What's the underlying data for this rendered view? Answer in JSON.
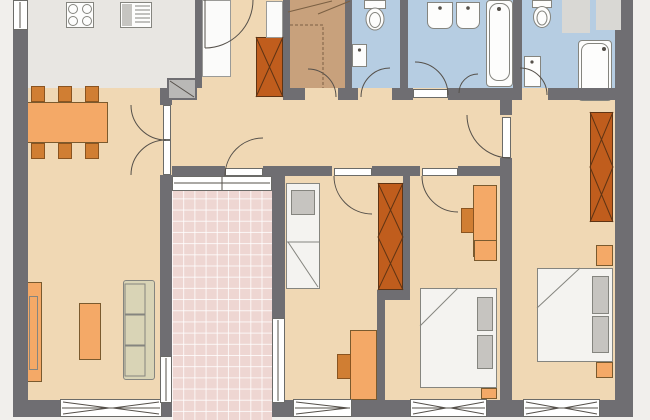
{
  "palette": {
    "wall": "#6f6e72",
    "stroke": "#55504a",
    "floor": "#f0d8b4",
    "kitchen_floor": "#e8e6e2",
    "bath_floor": "#b6cde2",
    "storage_floor": "#c8a17c",
    "terrace_floor": "#eed6d2",
    "margin": "#f1efec",
    "orange_light": "#f4a967",
    "orange_mid": "#d07e33",
    "orange_dark": "#c05d1d",
    "fixture_white": "#fdfdfc",
    "fixture_outline": "#85857f",
    "gray_item": "#c6c4c0",
    "niche_gray": "#d9d8d4",
    "sofa": "#d9d4b6"
  },
  "floor_plan": {
    "type": "apartment-floor-plan",
    "rooms": [
      {
        "name": "kitchen",
        "floor": "kitchen_floor",
        "fixtures": [
          "stove-4-burner",
          "kitchen-appliance",
          "tall-white-cabinet"
        ]
      },
      {
        "name": "living-dining-room",
        "floor": "floor",
        "fixtures": [
          "dining-table",
          "dining-chair x6",
          "tv-lowboard",
          "coffee-table",
          "sofa-3-seat",
          "double-door"
        ]
      },
      {
        "name": "entry-hall",
        "floor": "floor",
        "fixtures": [
          "entry-door",
          "wardrobe",
          "mirror-cabinet",
          "duct-shaft"
        ]
      },
      {
        "name": "storage-room",
        "floor": "storage_floor",
        "fixtures": [
          "dashed-shelving",
          "door"
        ]
      },
      {
        "name": "wc",
        "floor": "bath_floor",
        "fixtures": [
          "toilet",
          "hand-basin",
          "door"
        ]
      },
      {
        "name": "bathroom-1",
        "floor": "bath_floor",
        "fixtures": [
          "washbasin x2",
          "bathtub",
          "door"
        ]
      },
      {
        "name": "bathroom-2",
        "floor": "bath_floor",
        "fixtures": [
          "toilet",
          "hand-basin",
          "bathtub",
          "wall-niche x2",
          "door"
        ]
      },
      {
        "name": "bedroom-1",
        "floor": "floor",
        "fixtures": [
          "single-bed",
          "pillow",
          "wardrobe",
          "desk",
          "chair",
          "window",
          "door"
        ]
      },
      {
        "name": "bedroom-2",
        "floor": "floor",
        "fixtures": [
          "double-bed",
          "pillow x2",
          "desk",
          "chair",
          "nightstand x2",
          "window",
          "door"
        ]
      },
      {
        "name": "bedroom-3",
        "floor": "floor",
        "fixtures": [
          "double-bed",
          "pillow x2",
          "wardrobe",
          "nightstand x2",
          "window",
          "door"
        ]
      },
      {
        "name": "terrace",
        "floor": "terrace_floor",
        "fixtures": [
          "tile-grid",
          "terrace-door",
          "side-window x2"
        ]
      }
    ]
  }
}
